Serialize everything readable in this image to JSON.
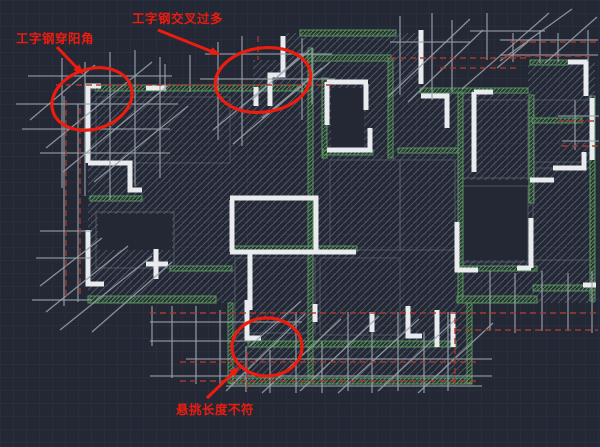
{
  "view": {
    "kind": "cad-floor-plan-markup"
  },
  "colors": {
    "background": "#232834",
    "grid_line": "#2d3544",
    "hatch_line": "#5a6272",
    "wall": "#e9ebee",
    "green_frame": "#5d9c63",
    "scaffold": "#9aa2ac",
    "red_dashed": "#a83a2e",
    "annotation_red": "#ed1c0f"
  },
  "annotations": [
    {
      "id": "i-beam-through-corner",
      "label": "工字钢穿阳角"
    },
    {
      "id": "i-beam-crossings-excessive",
      "label": "工字钢交叉过多"
    },
    {
      "id": "cantilever-length-mismatch",
      "label": "悬挑长度不符"
    }
  ]
}
